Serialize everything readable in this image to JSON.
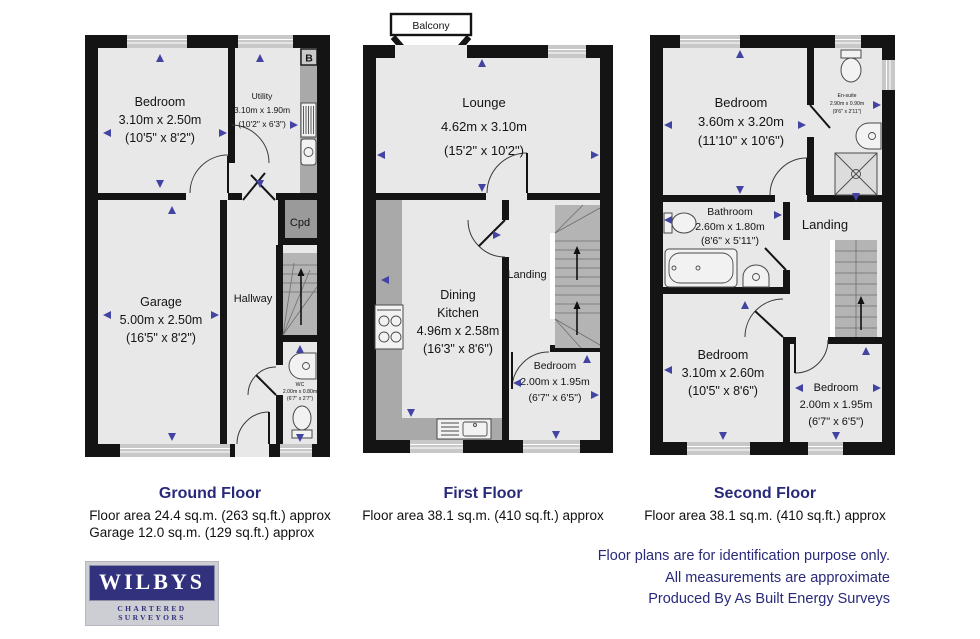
{
  "colors": {
    "wall": "#141414",
    "room": "#e8e8e8",
    "counter": "#a9a9a9",
    "stairs": "#b4b4b4",
    "cupboard": "#9a9a9a",
    "window": "#c8c8c8",
    "arrow": "#4343a2",
    "navy": "#29297b",
    "logo": "#31317d"
  },
  "floors": [
    {
      "title": "Ground Floor",
      "area_lines": [
        "Floor area 24.4 sq.m. (263 sq.ft.) approx",
        "Garage 12.0 sq.m. (129 sq.ft.) approx"
      ],
      "rooms": [
        {
          "lines": [
            "Bedroom",
            "3.10m x 2.50m",
            "(10'5\" x 8'2\")"
          ]
        },
        {
          "lines": [
            "Utility",
            "3.10m x 1.90m",
            "(10'2\" x 6'3\")"
          ]
        },
        {
          "lines": [
            "Cpd"
          ]
        },
        {
          "lines": [
            "Garage",
            "5.00m x 2.50m",
            "(16'5\" x 8'2\")"
          ]
        },
        {
          "lines": [
            "Hallway"
          ]
        },
        {
          "lines": [
            "WC",
            "2.00m x 0.80m",
            "(6'7\" x 2'7\")"
          ]
        },
        {
          "lines": [
            "B"
          ]
        }
      ]
    },
    {
      "title": "First Floor",
      "area_lines": [
        "Floor area 38.1 sq.m. (410 sq.ft.) approx"
      ],
      "rooms": [
        {
          "lines": [
            "Balcony"
          ]
        },
        {
          "lines": [
            "Lounge",
            "4.62m x 3.10m",
            "(15'2\" x 10'2\")"
          ]
        },
        {
          "lines": [
            "Dining",
            "Kitchen",
            "4.96m x 2.58m",
            "(16'3\" x 8'6\")"
          ]
        },
        {
          "lines": [
            "Landing"
          ]
        },
        {
          "lines": [
            "Bedroom",
            "2.00m x 1.95m",
            "(6'7\" x 6'5\")"
          ]
        }
      ]
    },
    {
      "title": "Second Floor",
      "area_lines": [
        "Floor area 38.1 sq.m. (410 sq.ft.) approx"
      ],
      "rooms": [
        {
          "lines": [
            "Bedroom",
            "3.60m x 3.20m",
            "(11'10\" x 10'6\")"
          ]
        },
        {
          "lines": [
            "En-suite",
            "2.90m x 0.90m",
            "(9'6\" x 2'11\")"
          ]
        },
        {
          "lines": [
            "Bathroom",
            "2.60m x 1.80m",
            "(8'6\" x 5'11\")"
          ]
        },
        {
          "lines": [
            "Landing"
          ]
        },
        {
          "lines": [
            "Bedroom",
            "3.10m x 2.60m",
            "(10'5\" x 8'6\")"
          ]
        },
        {
          "lines": [
            "Bedroom",
            "2.00m x 1.95m",
            "(6'7\" x 6'5\")"
          ]
        }
      ]
    }
  ],
  "notes": {
    "lines": [
      "Floor plans are for identification purpose only.",
      "All measurements are approximate",
      "Produced By As Built Energy Surveys"
    ]
  },
  "logo": {
    "name": "WILBYS",
    "tagline": "CHARTERED SURVEYORS"
  }
}
